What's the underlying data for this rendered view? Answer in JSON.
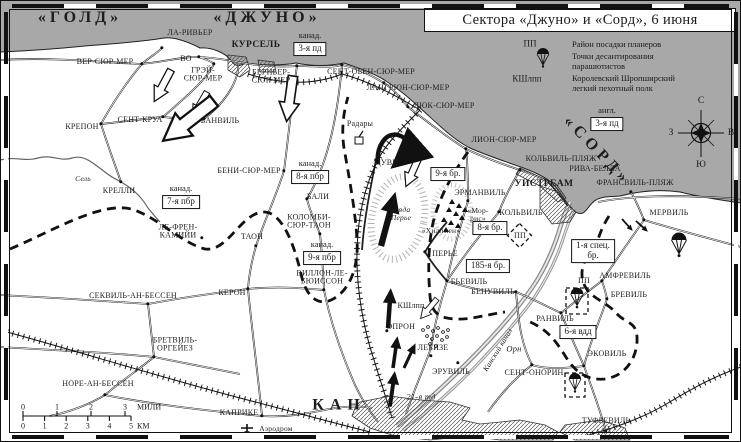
{
  "title": "Сектора «Джуно» и «Сорд», 6 июня",
  "colors": {
    "sea": "#a8a8a8",
    "land": "#ffffff",
    "ink": "#1a1a1a"
  },
  "legend": {
    "rows": [
      {
        "key": "ПП",
        "text": "Район посадки планеров"
      },
      {
        "key": "",
        "icon": "parachute-icon",
        "text": "Точки десантирования\nпарашютистов"
      },
      {
        "key": "КШлпп",
        "text": "Королевский Шропширский\nлегкий пехотный полк"
      }
    ]
  },
  "sectors": [
    {
      "name": "«ГОЛД»",
      "x": 80,
      "y": 18,
      "rot": 0
    },
    {
      "name": "«ДЖУНО»",
      "x": 267,
      "y": 18,
      "rot": 0
    },
    {
      "name": "«СОРД»",
      "x": 597,
      "y": 151,
      "rot": 46
    }
  ],
  "compass": {
    "n": "С",
    "e": "В",
    "s": "Ю",
    "w": "З"
  },
  "scale": {
    "miles": [
      "0",
      "1",
      "2",
      "3"
    ],
    "miles_unit": "МИЛИ",
    "km": [
      "0",
      "1",
      "2",
      "3",
      "4",
      "5"
    ],
    "km_unit": "КМ"
  },
  "boxes": [
    {
      "pre": "канад.",
      "label": "3-я пд",
      "x": 310,
      "y": 49
    },
    {
      "pre": "англ.",
      "label": "3-я пд",
      "x": 607,
      "y": 124
    },
    {
      "pre": "канад.",
      "label": "7-я пбр",
      "x": 181,
      "y": 202
    },
    {
      "pre": "канад.",
      "label": "8-я пбр",
      "x": 310,
      "y": 177
    },
    {
      "pre": "канад.",
      "label": "9-я пбр",
      "x": 322,
      "y": 258
    },
    {
      "label": "9-я бр.",
      "x": 448,
      "y": 174
    },
    {
      "label": "8-я бр.",
      "x": 490,
      "y": 228
    },
    {
      "label": "185-я бр.",
      "x": 488,
      "y": 266
    },
    {
      "label": "1-я спец.\nбр.",
      "x": 593,
      "y": 251
    },
    {
      "label": "6-я вдд",
      "x": 578,
      "y": 332
    }
  ],
  "places": [
    {
      "name": "ЛА-РИВЬЕР",
      "x": 190,
      "y": 33,
      "dot": [
        162,
        48
      ]
    },
    {
      "name": "ВЕР-СЮР-МЕР",
      "x": 105,
      "y": 62,
      "dot": [
        142,
        64
      ]
    },
    {
      "name": "ВО",
      "x": 186,
      "y": 59,
      "dot": [
        199,
        57
      ]
    },
    {
      "name": "КУРСЕЛЬ",
      "x": 256,
      "y": 46,
      "cls": "bold"
    },
    {
      "name": "ГРЭЙ-\nСЮР-МЕР",
      "x": 203,
      "y": 75,
      "dot": [
        214,
        64
      ]
    },
    {
      "name": "СЕНТ-КРУА",
      "x": 140,
      "y": 120,
      "dot": [
        163,
        117
      ]
    },
    {
      "name": "КРЕПОН",
      "x": 82,
      "y": 127,
      "dot": [
        101,
        124
      ]
    },
    {
      "name": "БАНВИЛЬ",
      "x": 220,
      "y": 121,
      "dot": [
        204,
        119
      ]
    },
    {
      "name": "БЕРНЬЕР-\nСЮР-МЕР",
      "x": 271,
      "y": 77,
      "dot": [
        297,
        66
      ]
    },
    {
      "name": "СЕНТ-ОБЕН-СЮР-МЕР",
      "x": 371,
      "y": 72,
      "dot": [
        342,
        65
      ]
    },
    {
      "name": "ЛАНГРЮН-СЮР-МЕР",
      "x": 408,
      "y": 88,
      "dot": [
        384,
        83
      ]
    },
    {
      "name": "ЛЮК-СЮР-МЕР",
      "x": 444,
      "y": 106,
      "dot": [
        408,
        107
      ]
    },
    {
      "name": "ЛИОН-СЮР-МЕР",
      "x": 504,
      "y": 140,
      "dot": [
        466,
        149
      ]
    },
    {
      "name": "ДУВР",
      "x": 386,
      "y": 163,
      "dot": [
        376,
        160
      ]
    },
    {
      "name": "Радары",
      "x": 360,
      "y": 124
    },
    {
      "name": "КРЕЛЛИ",
      "x": 119,
      "y": 191,
      "dot": [
        121,
        182
      ]
    },
    {
      "name": "Сель",
      "x": 83,
      "y": 179,
      "cls": "italsm"
    },
    {
      "name": "БЕНИ-СЮР-МЕР",
      "x": 249,
      "y": 171,
      "dot": [
        284,
        171
      ]
    },
    {
      "name": "БАЛИ",
      "x": 318,
      "y": 197,
      "dot": [
        307,
        199
      ]
    },
    {
      "name": "КОЛОМБИ-\nСЮР-ТАОН",
      "x": 309,
      "y": 222,
      "dot": [
        320,
        234
      ]
    },
    {
      "name": "ТАОН",
      "x": 252,
      "y": 237,
      "dot": [
        256,
        246
      ]
    },
    {
      "name": "ЛЕ-ФРЕН-\nКАМИЙИ",
      "x": 178,
      "y": 232,
      "dot": [
        202,
        238
      ]
    },
    {
      "name": "СЕКВИЛЬ-АН-БЕССЕН",
      "x": 133,
      "y": 296,
      "dot": [
        148,
        304
      ]
    },
    {
      "name": "КЕРОН",
      "x": 232,
      "y": 293,
      "dot": [
        248,
        289
      ]
    },
    {
      "name": "БРЕТВИЛЬ-\nОРГЕЙЕЗ",
      "x": 175,
      "y": 345,
      "dot": [
        154,
        357
      ]
    },
    {
      "name": "НОРЕ-АН-БЕССЕН",
      "x": 98,
      "y": 384,
      "dot": [
        105,
        395
      ]
    },
    {
      "name": "ВИЛЛОН-ЛЕ-\nБЮИССОН",
      "x": 322,
      "y": 278,
      "dot": [
        324,
        290
      ]
    },
    {
      "name": "ЭПРОН",
      "x": 401,
      "y": 327,
      "dot": [
        387,
        331
      ]
    },
    {
      "name": "ЛЕБИЗЕ",
      "x": 433,
      "y": 348,
      "dot": [
        431,
        356
      ]
    },
    {
      "name": "ЭРУВИЛЬ",
      "x": 451,
      "y": 372,
      "dot": [
        458,
        363
      ]
    },
    {
      "name": "КАН",
      "x": 339,
      "y": 406,
      "cls": "city"
    },
    {
      "name": "КАПРИКЕ",
      "x": 239,
      "y": 413,
      "dot": [
        262,
        416
      ]
    },
    {
      "name": "Аэродром",
      "x": 276,
      "y": 429,
      "cls": "small"
    },
    {
      "name": "21-я тд",
      "x": 421,
      "y": 397,
      "cls": "ital"
    },
    {
      "name": "КШлпп",
      "x": 411,
      "y": 306
    },
    {
      "name": "гряда\nПерье",
      "x": 401,
      "y": 214,
      "cls": "italsm"
    },
    {
      "name": "ПЕРЬЕ",
      "x": 445,
      "y": 254,
      "dot": [
        425,
        252
      ]
    },
    {
      "name": "«Мор-\nрис»",
      "x": 478,
      "y": 215,
      "cls": "small"
    },
    {
      "name": "«Хиллмен»",
      "x": 441,
      "y": 231,
      "cls": "small"
    },
    {
      "name": "ЭРМАНВИЛЬ",
      "x": 480,
      "y": 193,
      "dot": [
        468,
        201
      ]
    },
    {
      "name": "КОЛЬВИЛЬ",
      "x": 521,
      "y": 213,
      "dot": [
        499,
        212
      ]
    },
    {
      "name": "БЬЕВИЛЬ",
      "x": 469,
      "y": 282,
      "dot": [
        447,
        281
      ]
    },
    {
      "name": "БЕНУВИЛЬ",
      "x": 493,
      "y": 292,
      "dot": [
        516,
        292
      ]
    },
    {
      "name": "УИСТРЕАМ",
      "x": 544,
      "y": 185,
      "cls": "bold"
    },
    {
      "name": "КОЛЬВИЛЬ-ПЛЯЖ",
      "x": 561,
      "y": 159,
      "dot": [
        520,
        170
      ]
    },
    {
      "name": "РИВА-БЕЛЛА",
      "x": 595,
      "y": 169
    },
    {
      "name": "ФРАНСВИЛЬ-ПЛЯЖ",
      "x": 635,
      "y": 183,
      "dot": [
        631,
        192
      ]
    },
    {
      "name": "МЕРВИЛЬ",
      "x": 669,
      "y": 213,
      "dot": [
        644,
        220
      ]
    },
    {
      "name": "АМФРЕВИЛЬ",
      "x": 625,
      "y": 276,
      "dot": [
        602,
        281
      ]
    },
    {
      "name": "БРЕВИЛЬ",
      "x": 629,
      "y": 295,
      "dot": [
        607,
        299
      ]
    },
    {
      "name": "РАНВИЛЬ",
      "x": 555,
      "y": 319,
      "dot": [
        561,
        313
      ]
    },
    {
      "name": "ЭКОВИЛЬ",
      "x": 607,
      "y": 354,
      "dot": [
        584,
        366
      ]
    },
    {
      "name": "СЕНТ-ОНОРИН",
      "x": 534,
      "y": 373,
      "dot": [
        532,
        365
      ]
    },
    {
      "name": "ТУФРЕВИЛЬ",
      "x": 606,
      "y": 421,
      "dot": [
        606,
        431
      ]
    },
    {
      "name": "Орн",
      "x": 514,
      "y": 349,
      "cls": "ital"
    },
    {
      "name": "Канский канал",
      "x": 498,
      "y": 350,
      "cls": "italsm",
      "rot": -58
    },
    {
      "name": "ПП",
      "x": 520,
      "y": 236
    },
    {
      "name": "ПП",
      "x": 584,
      "y": 281
    }
  ]
}
